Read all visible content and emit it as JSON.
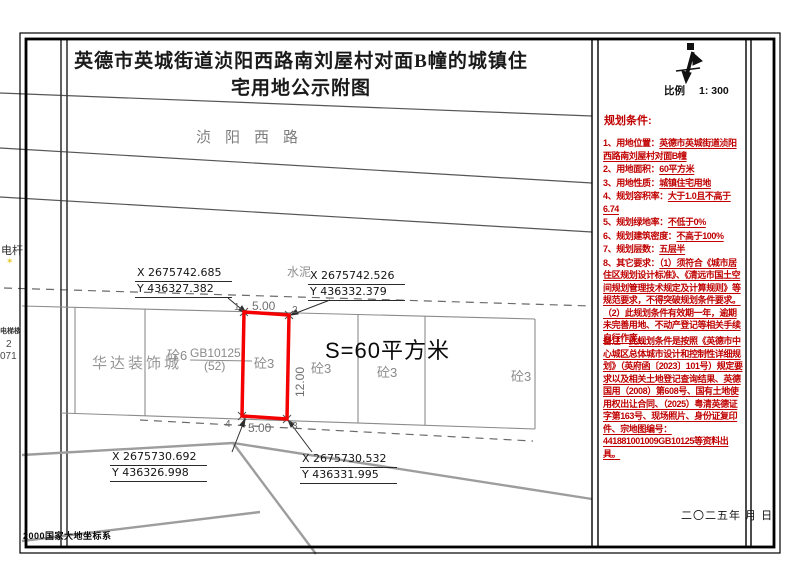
{
  "sheet": {
    "title": "英德市英城街道浈阳西路南刘屋村对面B幢的城镇住宅用地公示附图",
    "crs_note": "2000国家大地坐标系"
  },
  "map": {
    "road_name": "浈阳西路",
    "surface_label": "水泥",
    "area_label": "S=60平方米",
    "complex_name": "华达装饰城",
    "parcel_code": "GB10125",
    "parcel_code_sub": "(52)",
    "parcel_labels": [
      "砼6",
      "砼3",
      "砼3",
      "砼3",
      "砼3"
    ],
    "margin_labels": {
      "pole": "电杆",
      "building": "电梯楼",
      "num_a": "2",
      "num_b": "071"
    },
    "dims": {
      "top": "5.00",
      "right": "12.00",
      "bottom": "5.00"
    },
    "corners": [
      {
        "no": "1",
        "x": "X 2675742.685",
        "y": "Y 436327.382"
      },
      {
        "no": "2",
        "x": "X 2675742.526",
        "y": "Y 436332.379"
      },
      {
        "no": "3",
        "x": "X 2675730.532",
        "y": "Y 436331.995"
      },
      {
        "no": "4",
        "x": "X 2675730.692",
        "y": "Y 436326.998"
      }
    ]
  },
  "panel": {
    "scale_label": "比例",
    "scale_value": "1: 300",
    "conditions_title": "规划条件:",
    "conditions": [
      {
        "label": "1、用地位置：",
        "value": "英德市英城街道浈阳西路南刘屋村对面B幢"
      },
      {
        "label": "2、用地面积：",
        "value": "60平方米"
      },
      {
        "label": "3、用地性质：",
        "value": "城镇住宅用地"
      },
      {
        "label": "4、规划容积率：",
        "value": "大于1.0且不高于6.74"
      },
      {
        "label": "5、规划绿地率：",
        "value": "不低于0%"
      },
      {
        "label": "6、规划建筑密度：",
        "value": "不高于100%"
      },
      {
        "label": "7、规划层数：",
        "value": "五层半"
      },
      {
        "label": "8、其它要求：",
        "value": "（1）须符合《城市居住区规划设计标准》、《清远市国土空间规划管理技术规定及计算规则》等规范要求，不得突破规划条件要求。（2）此规划条件有效期一年，逾期未完善用地、不动产登记等相关手续自行作废。"
      }
    ],
    "note": {
      "label": "备注：",
      "value": "此规划条件是按照《英德市中心城区总体城市设计和控制性详细规划》（英府函〔2023〕101号）规定要求以及相关土地登记查询结果、英德国用（2008）第608号、国有土地使用权出让合同、（2025）粤清英德证字第163号、现场照片、身份证复印件、宗地图编号：441881001009GB10125等资料出具。"
    },
    "date": "二〇二五年 月 日"
  },
  "icons": {
    "pole_marker": "✶"
  },
  "colors": {
    "plot_red": "#f40000",
    "text_red": "#c00000"
  }
}
